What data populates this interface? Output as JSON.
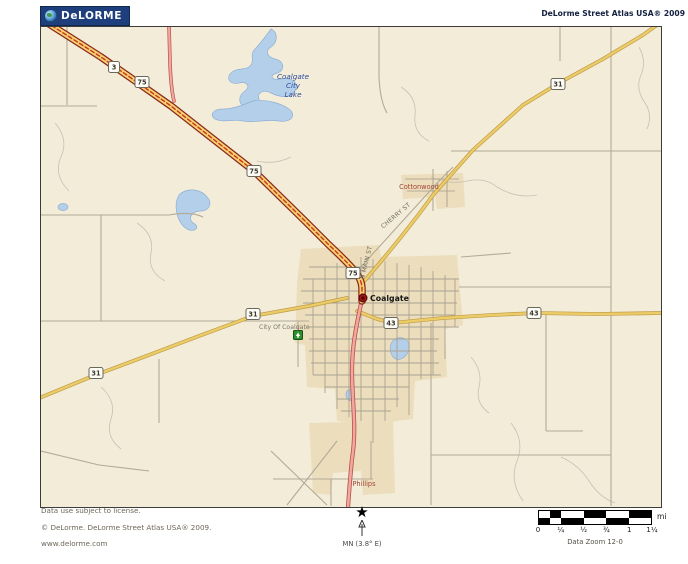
{
  "header": {
    "logo_text": "DeLORME",
    "title": "DeLorme Street Atlas USA® 2009"
  },
  "map": {
    "lake_label": {
      "line1": "Coalgate",
      "line2": "City",
      "line3": "Lake"
    },
    "towns": {
      "coalgate": "Coalgate",
      "cottonwood": "Cottonwood",
      "phillips": "Phillips"
    },
    "poi": {
      "city_of_coalgate": "City Of Coalgate"
    },
    "streets": {
      "main": "N MAIN ST",
      "cherry": "CHERRY ST"
    },
    "shields": [
      {
        "label": "3"
      },
      {
        "label": "75"
      },
      {
        "label": "75"
      },
      {
        "label": "75"
      },
      {
        "label": "31"
      },
      {
        "label": "31"
      },
      {
        "label": "31"
      },
      {
        "label": "43"
      },
      {
        "label": "43"
      }
    ],
    "colors": {
      "land": "#f2ecd9",
      "urban": "#ecdebc",
      "water": "#b3cfe9",
      "water_outline": "#8fb0d4",
      "highway_fill": "#f5d36e",
      "highway_casing": "#8c2820",
      "highway_dash": "#c93425",
      "road_yellow": "#eccb69",
      "road_yellow_casing": "#bf9c45",
      "road_pink": "#f2a8a0",
      "road_pink_casing": "#b85048",
      "road_gray": "#b3aa97"
    }
  },
  "footer": {
    "license": "Data use subject to license.",
    "copyright": "© DeLorme. DeLorme Street Atlas USA® 2009.",
    "website": "www.delorme.com",
    "north_label": "MN (3.8° E)",
    "scale": {
      "unit": "mi",
      "ticks": [
        "0",
        "¼",
        "½",
        "¾",
        "1",
        "1¼"
      ],
      "zoom_label": "Data Zoom 12-0"
    }
  }
}
